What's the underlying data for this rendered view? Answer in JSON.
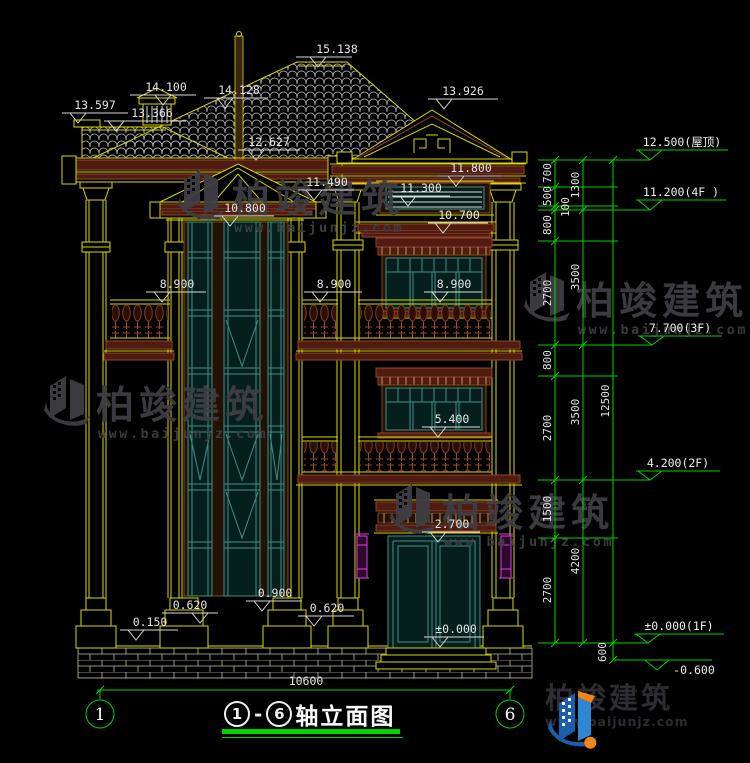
{
  "title_block": {
    "axis_start": "1",
    "dash": "-",
    "axis_end": "6",
    "text": "轴立面图"
  },
  "axes": {
    "left": "1",
    "right": "6"
  },
  "marks": [
    "15.138",
    "14.100",
    "14.128",
    "13.597",
    "13.366",
    "13.926",
    "12.627",
    "11.800",
    "11.490",
    "11.300",
    "10.800",
    "10.700",
    "8.900",
    "8.900",
    "8.900",
    "5.400",
    "2.700",
    "±0.000",
    "0.900",
    "0.620",
    "0.620",
    "0.150"
  ],
  "levels": [
    {
      "label": "12.500(屋顶)"
    },
    {
      "label": "11.200(4F )"
    },
    {
      "label": "7.700(3F)"
    },
    {
      "label": "4.200(2F)"
    },
    {
      "label": "±0.000(1F)"
    },
    {
      "label": "-0.600"
    }
  ],
  "dims": {
    "col1": [
      "700",
      "500",
      "100",
      "800",
      "2700",
      "800",
      "2700",
      "1500",
      "2700"
    ],
    "col2": [
      "1300",
      "3500",
      "3500",
      "4200"
    ],
    "col3": [
      "12500",
      "600"
    ],
    "overall_width": "10600"
  },
  "watermark": {
    "name": "柏竣建筑",
    "url": "www.baijunjz.com"
  },
  "logo": {
    "name": "柏竣建筑",
    "url": "www.baijunjz.com"
  },
  "colors": {
    "cad_yellow": "#d8d800",
    "cad_green": "#00d400",
    "cad_white": "#e6e6e6",
    "maroon": "#99422a",
    "brown": "#7a4a22",
    "teal": "#3f8f86",
    "magenta": "#e53ae5",
    "watermark_gray": "#3e3e44",
    "logo_blue": "#1a5fae",
    "logo_orange": "#f08519"
  }
}
